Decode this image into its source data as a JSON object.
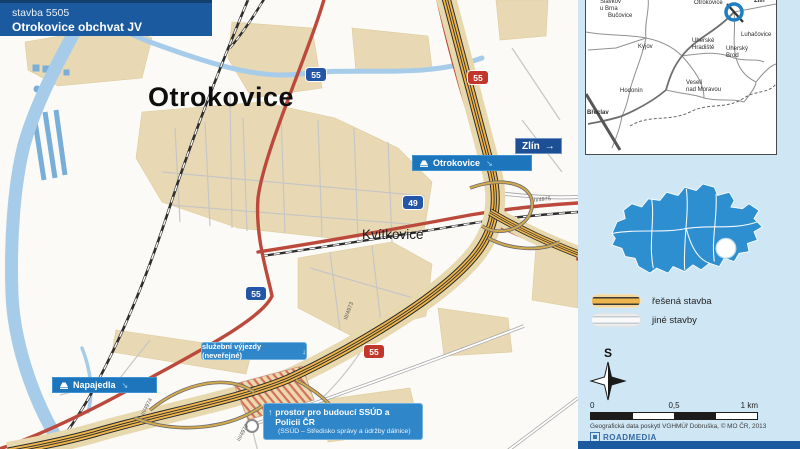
{
  "title": {
    "line1": "stavba 5505",
    "line2": "Otrokovice obchvat JV"
  },
  "map": {
    "city": "Otrokovice",
    "district": "Kvítkovice",
    "flags": [
      {
        "label": "Otrokovice"
      },
      {
        "label": "Napajedla"
      }
    ],
    "direction_sign": {
      "label": "Zlín",
      "arrow": "→"
    },
    "callout_service": {
      "text": "služební výjezdy (neveřejné)",
      "arrow": "↓"
    },
    "callout_ssud": {
      "arrow": "↑",
      "line1": "prostor pro budoucí SSÚD a Policii ČR",
      "line2": "(SSÚD – Středisko správy a údržby dálnice)"
    },
    "shields": [
      {
        "number": "55",
        "type": "blue"
      },
      {
        "number": "55",
        "type": "red"
      },
      {
        "number": "49",
        "type": "blue"
      },
      {
        "number": "55",
        "type": "blue"
      },
      {
        "number": "55",
        "type": "red"
      }
    ],
    "minor_road_labels": [
      {
        "text": "III/4973"
      },
      {
        "text": "III/4974"
      },
      {
        "text": "III/4972"
      },
      {
        "text": "II/4975"
      }
    ]
  },
  "inset": {
    "towns": [
      {
        "name": "Otrokovice"
      },
      {
        "name": "Zlín"
      },
      {
        "name": "Slavkov\nu Brna"
      },
      {
        "name": "Bučovice"
      },
      {
        "name": "Kyjov"
      },
      {
        "name": "Luhačovice"
      },
      {
        "name": "Uherské\nHradiště"
      },
      {
        "name": "Uherský\nBrod"
      },
      {
        "name": "Veselí\nnad Moravou"
      },
      {
        "name": "Hodonín"
      },
      {
        "name": "Břeclav"
      }
    ]
  },
  "legend": {
    "items": [
      {
        "label": "řešená stavba"
      },
      {
        "label": "jiné stavby"
      }
    ]
  },
  "compass": {
    "north_label": "S"
  },
  "scale": {
    "t0": "0",
    "t05": "0,5",
    "t1": "1 km"
  },
  "attribution": "Geografická data poskytl VGHMÚř Dobruška, © MO ČR, 2013",
  "logo": {
    "name": "RoadMedia"
  },
  "colors": {
    "accent_blue": "#1b5a9e",
    "panel_blue": "#cfe7f5",
    "construction_orange": "#eeb54d",
    "road_red": "#bc4a3c",
    "shield_blue": "#2456a8",
    "shield_red": "#c3362b",
    "cz_map_blue": "#2e8fd0"
  }
}
